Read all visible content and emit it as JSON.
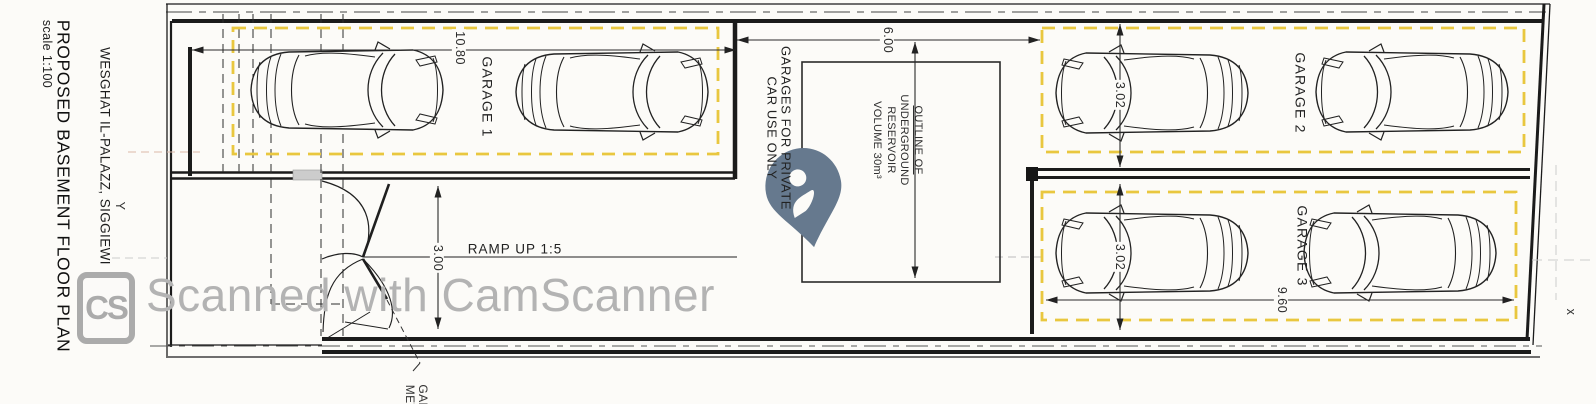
{
  "title_block": {
    "address": "WESGHAT IL-PALAZZ, SIGGIEWI",
    "title": "PROPOSED BASEMENT FLOOR PLAN",
    "scale": "scale 1:100"
  },
  "axes": {
    "y_marker": "Y",
    "x_marker": "x"
  },
  "garages": {
    "garage1": "GARAGE 1",
    "garage2": "GARAGE 2",
    "garage3": "GARAGE 3"
  },
  "notes": {
    "usage_line1": "GARAGES FOR PRIVATE",
    "usage_line2": "CAR USE ONLY",
    "reservoir_line1": "OUTLINE OF",
    "reservoir_line2": "UNDERGROUND",
    "reservoir_line3": "RESERVOIR",
    "reservoir_line4": "VOLUME 30m³",
    "ramp": "RAMP UP 1:5",
    "meter_line1": "GAR",
    "meter_line2": "MET"
  },
  "dimensions": {
    "garage1_length": "10.80",
    "entrance_width": "6.00",
    "garage2_width": "3.02",
    "garage3_width": "3.02",
    "garage3_length": "9.60",
    "ramp_width": "3.00"
  },
  "watermark": {
    "logo": "CS",
    "text": "Scanned with CamScanner"
  },
  "colors": {
    "garage_bay_outline": "#e9c73f",
    "location_pin": "#66798e",
    "watermark_grey": "#b3b3b3",
    "ink": "#1b1b1b"
  }
}
